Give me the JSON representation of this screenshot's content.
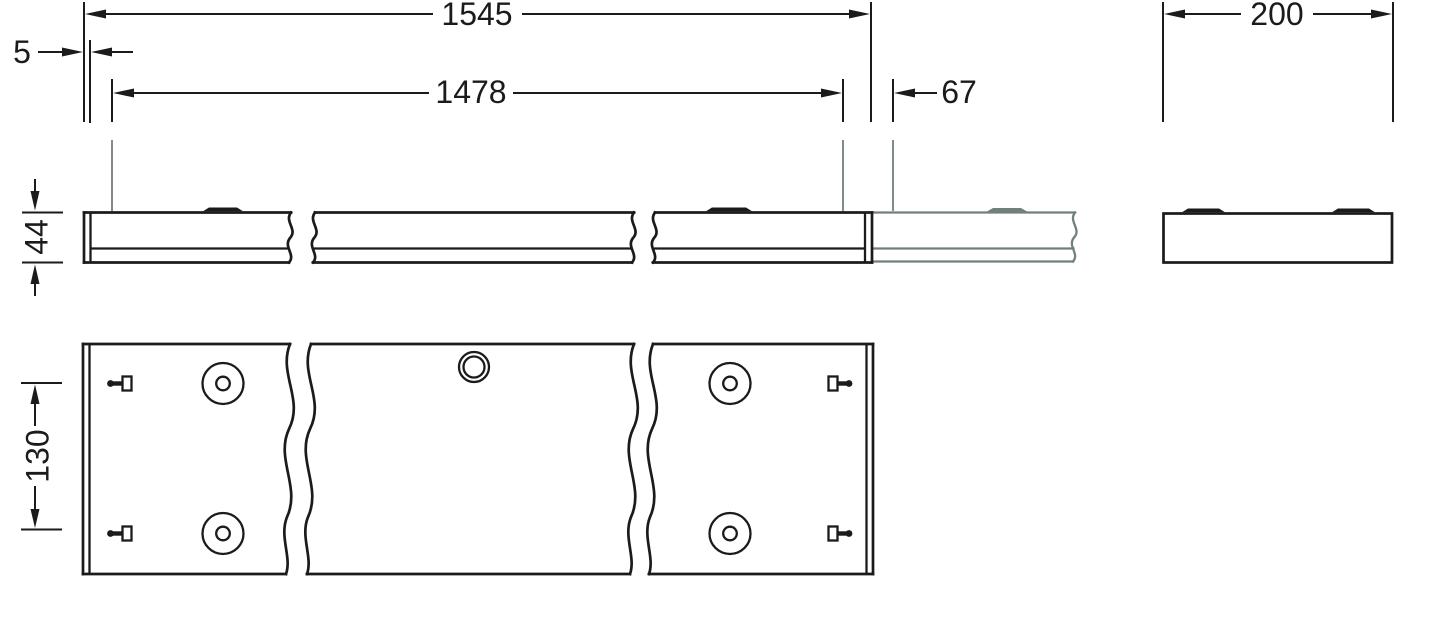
{
  "dimensions": {
    "overall_length": "1545",
    "end_inset": "5",
    "suspension_spacing": "1478",
    "suspension_end_offset": "67",
    "housing_width": "200",
    "housing_height": "44",
    "mounting_row_spacing": "130"
  },
  "colors": {
    "line": "#1b1b1b",
    "continuation_gray": "#72807d",
    "background": "#ffffff"
  }
}
